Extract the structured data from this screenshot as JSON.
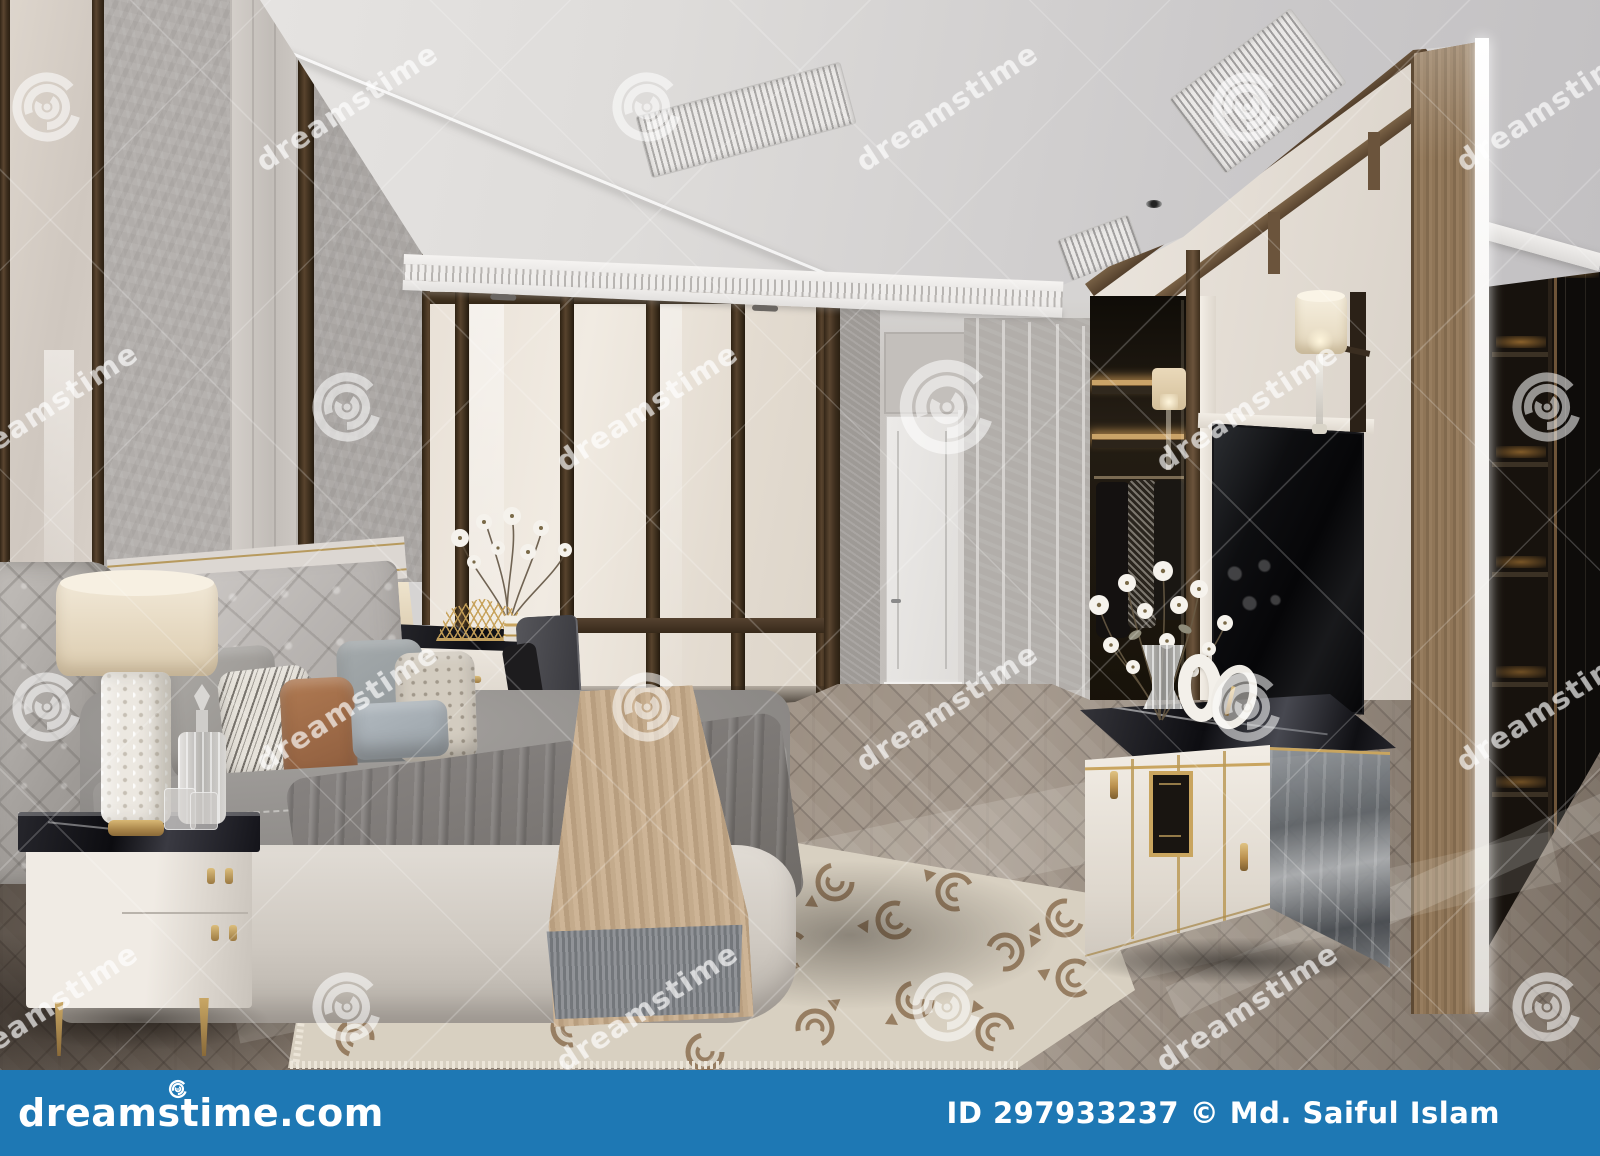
{
  "image": {
    "kind": "stock-photo-preview",
    "subject": "Modern classic luxury bedroom interior - gray tufted bed with pillows, table lamps on white nightstand, cream wardrobe wall, TV console with flowers, walk-in closet and herringbone wood floor (3D rendering)"
  },
  "watermark": {
    "text": "dreamstime",
    "spiral_icon": "dreamstime-spiral-logo"
  },
  "footer": {
    "logo_text": "dreamstime.com",
    "credit_text": "ID 297933237 © Md. Saiful Islam"
  },
  "palette": {
    "footer-blue": "#1e78b4",
    "ceiling": "#dcdad8",
    "plaster": "#b1adaa",
    "cream-panel": "#e9e1d7",
    "wood-dark": "#4a3828",
    "wood-pillar": "#8d7357",
    "floor-wood": "#9b8e81",
    "rug-base": "#ded6c8",
    "rug-motif": "#87694a",
    "marble-black": "#141418",
    "gold": "#c2a05e",
    "bed-gray": "#908d8a",
    "throw-beige": "#c2aa8c",
    "fringe-gray": "#7e858c",
    "tv-black": "#070709",
    "closet-dark": "#17120d",
    "led-amber": "#c08a4a"
  }
}
